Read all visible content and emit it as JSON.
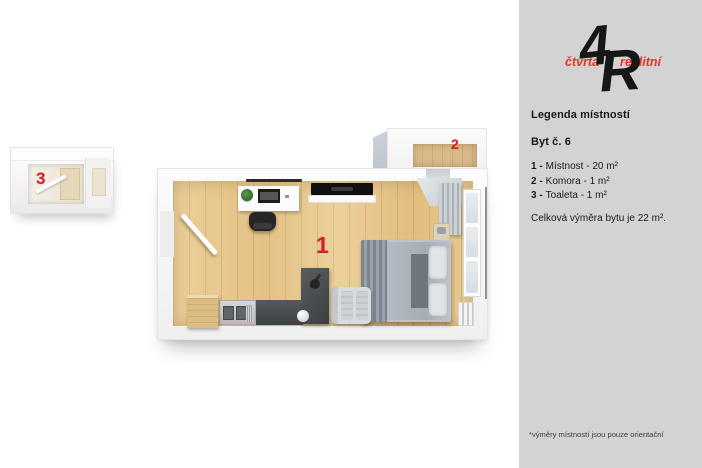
{
  "sidebar": {
    "logo": {
      "digit": "4",
      "letter": "R",
      "word_left": "čtvrtá",
      "word_right": "realitní"
    },
    "legend_title": "Legenda místností",
    "unit_title": "Byt č. 6",
    "rooms": [
      {
        "prefix": "1 -",
        "text": "Místnost - 20 m²"
      },
      {
        "prefix": "2 -",
        "text": "Komora - 1 m²"
      },
      {
        "prefix": "3 -",
        "text": "Toaleta - 1 m²"
      }
    ],
    "total_text": "Celková výměra bytu je 22 m².",
    "footnote": "*výměry místností jsou pouze orientační"
  },
  "plan": {
    "room1_label": "1",
    "room2_label": "2",
    "room3_label": "3"
  },
  "colors": {
    "accent_red": "#d2232a",
    "logo_red": "#e63323",
    "sidebar_bg": "#d3d3d3",
    "floor_wood": "#e7c88d",
    "counter_dark": "#454545"
  }
}
